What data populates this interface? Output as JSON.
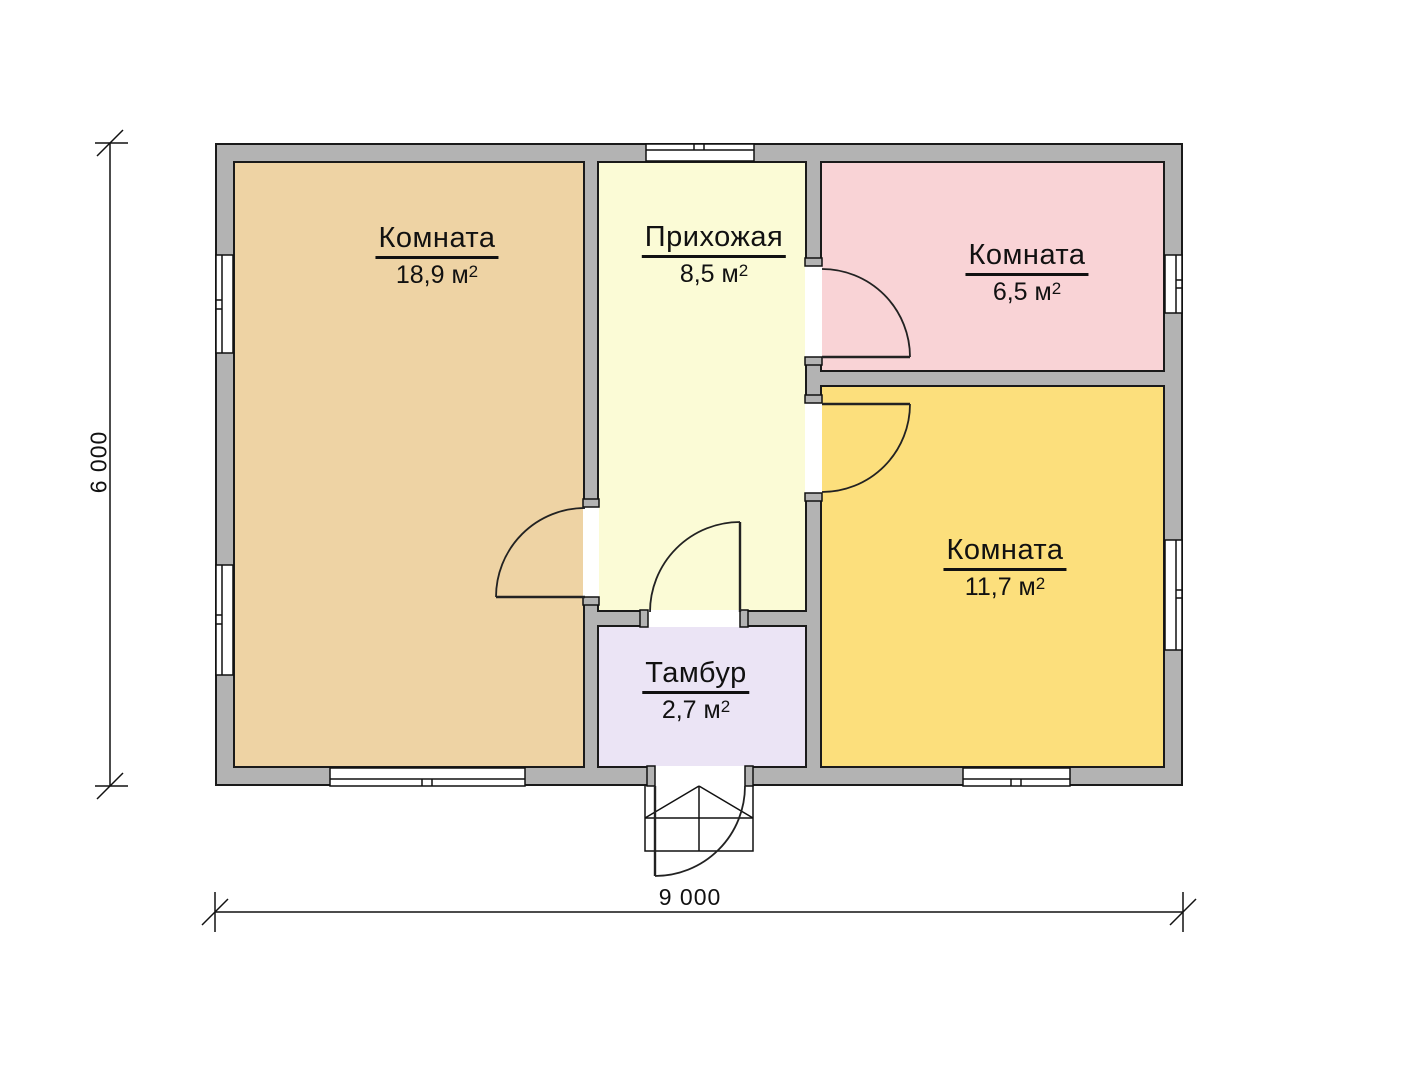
{
  "plan": {
    "rooms": [
      {
        "id": "room-living",
        "name": "Комната",
        "area": "18,9 м",
        "area_sup": "2",
        "color": "#eed3a4"
      },
      {
        "id": "hallway",
        "name": "Прихожая",
        "area": "8,5 м",
        "area_sup": "2",
        "color": "#fbfbd6"
      },
      {
        "id": "room-small",
        "name": "Комната",
        "area": "6,5 м",
        "area_sup": "2",
        "color": "#f9d3d6"
      },
      {
        "id": "room-medium",
        "name": "Комната",
        "area": "11,7 м",
        "area_sup": "2",
        "color": "#fcdf7c"
      },
      {
        "id": "tambur",
        "name": "Тамбур",
        "area": "2,7 м",
        "area_sup": "2",
        "color": "#ebe4f5"
      }
    ],
    "dimensions": {
      "width_label": "9 000",
      "height_label": "6 000"
    },
    "colors": {
      "wall": "#b3b3b3",
      "outline": "#1a1a1a",
      "background": "#ffffff"
    }
  }
}
